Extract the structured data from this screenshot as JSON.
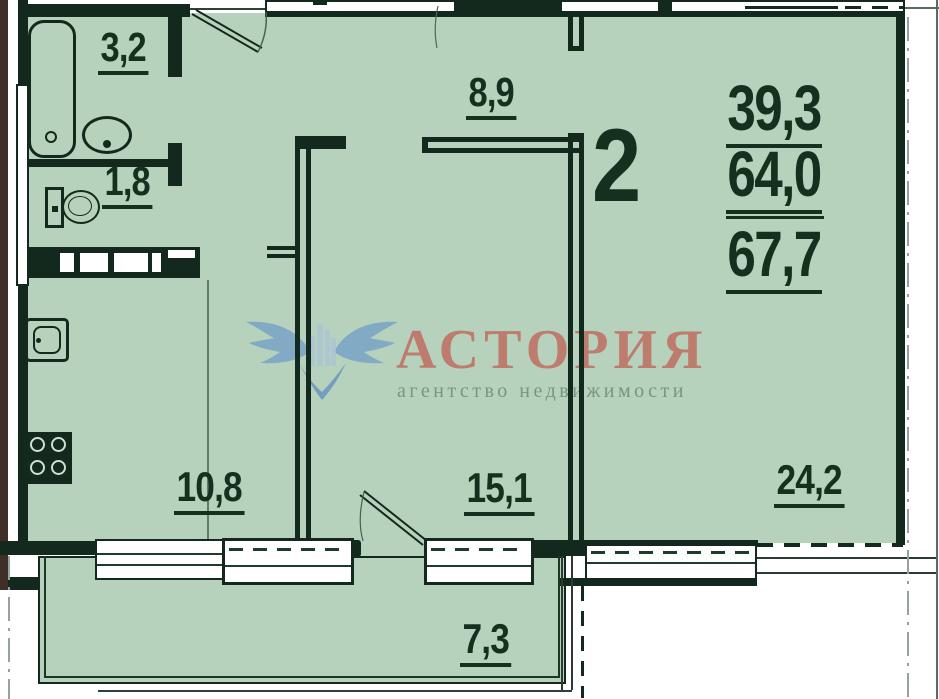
{
  "plan": {
    "apartment_number": "2",
    "summary": {
      "living_area": "39,3",
      "total_area": "64,0",
      "total_with_balcony": "67,7"
    },
    "rooms": {
      "bathroom": "3,2",
      "wc": "1,8",
      "hallway": "8,9",
      "kitchen": "10,8",
      "room": "15,1",
      "living_room": "24,2",
      "balcony": "7,3"
    }
  },
  "watermark": {
    "brand": "АСТОРИЯ",
    "tagline": "агентство недвижимости"
  },
  "colors": {
    "floor_green": "#b6d2bc",
    "wall_dark": "#13291d",
    "label_dark": "#16301f",
    "brand_red": "#c0675c",
    "tagline_green": "#74937e",
    "logo_blue": "#7aa3c5",
    "outer_brown": "#3f2f26"
  }
}
